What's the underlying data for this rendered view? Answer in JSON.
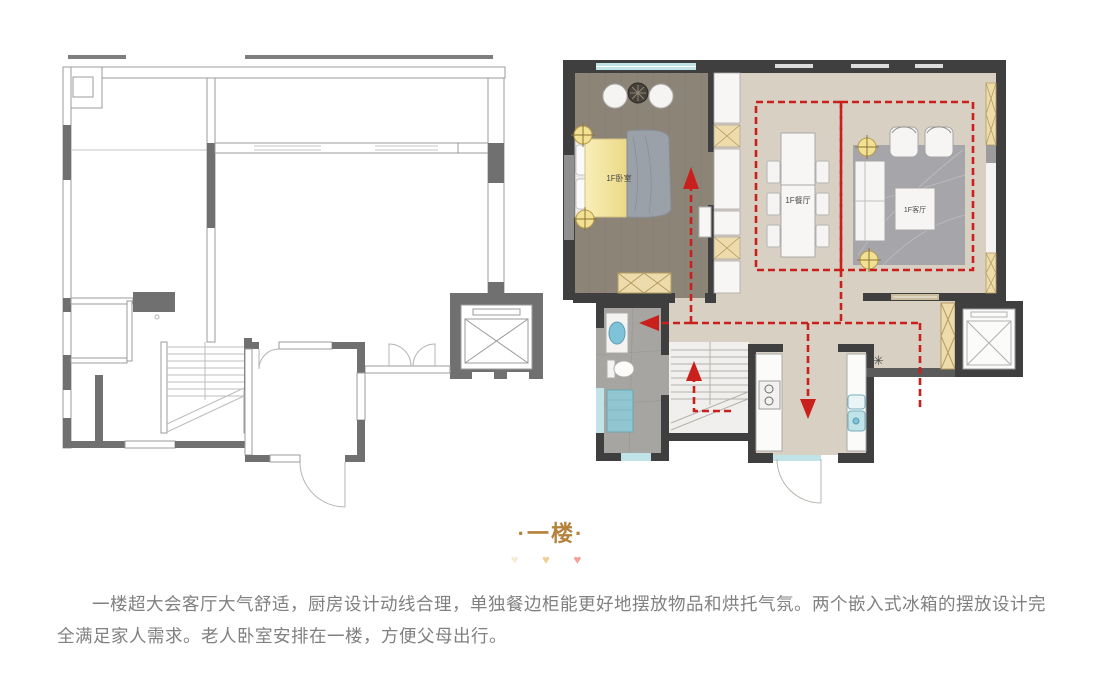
{
  "section": {
    "title": "·一楼·",
    "heart_glyph": "♥",
    "paragraph": "一楼超大会客厅大气舒适，厨房设计动线合理，单独餐边柜能更好地摆放物品和烘托气氛。两个嵌入式冰箱的摆放设计完全满足家人需求。老人卧室安排在一楼，方便父母出行。"
  },
  "floorplan_right": {
    "rooms": [
      {
        "label": "1F卧室"
      },
      {
        "label": "1F餐厅"
      },
      {
        "label": "1F客厅"
      }
    ]
  },
  "colors": {
    "title_gold": "#b5823c",
    "heart_cream": "#f6ecd6",
    "heart_yellow": "#efd195",
    "heart_pink": "#f2a096",
    "body_text_gray": "#808080",
    "route_red": "#c9201d",
    "wall_dark": "#3f3f3f",
    "floor_wood_gray": "#8d8478",
    "floor_beige": "#d8d1c3",
    "bath_tile_gray": "#a7a5a1",
    "window_blue": "#bfe3e6",
    "cabinet_tan": "#eedbab",
    "ceiling_light_yellow": "#f2e193",
    "outline_plan_gray": "#9b9b9b"
  }
}
